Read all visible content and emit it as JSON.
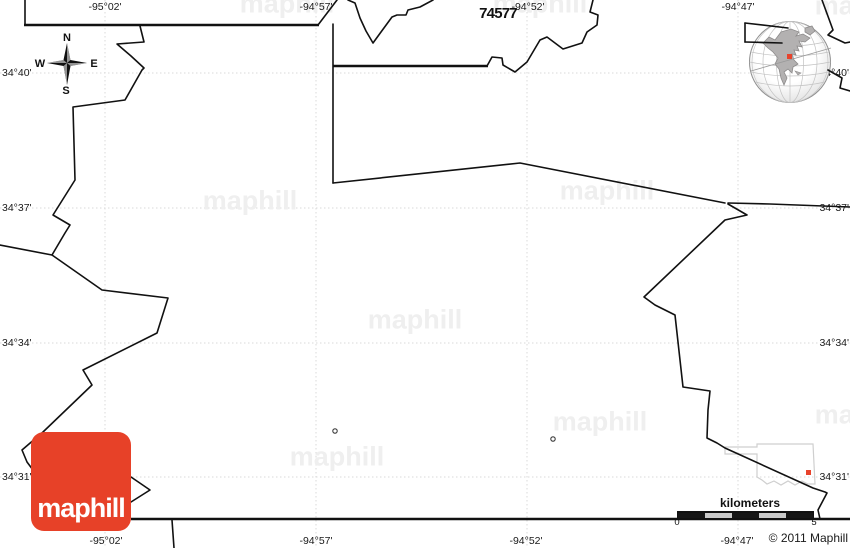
{
  "map": {
    "zip_code": "74577",
    "labels": {
      "top": [
        "-95°02'",
        "-94°57'",
        "-94°52'",
        "-94°47'"
      ],
      "bottom": [
        "-95°02'",
        "-94°57'",
        "-94°52'",
        "-94°47'"
      ],
      "left": [
        "34°40'",
        "34°37'",
        "34°34'",
        "34°31'"
      ],
      "right": [
        "34°40'",
        "34°37'",
        "34°34'",
        "34°31'"
      ]
    },
    "compass": {
      "north": "N",
      "east": "E",
      "south": "S",
      "west": "W"
    },
    "scale_bar": {
      "title": "kilometers",
      "min": "0",
      "max": "5"
    },
    "copyright": "© 2011 Maphill",
    "logo_text": "maphill",
    "watermark_text": "maphill",
    "colors": {
      "boundary": "#111111",
      "grid_dotted": "#d9d9d9",
      "logo_red": "#e74128",
      "marker_red": "#e8432c",
      "inset_outline": "#cfcfcf",
      "watermark": "#efefef"
    }
  }
}
